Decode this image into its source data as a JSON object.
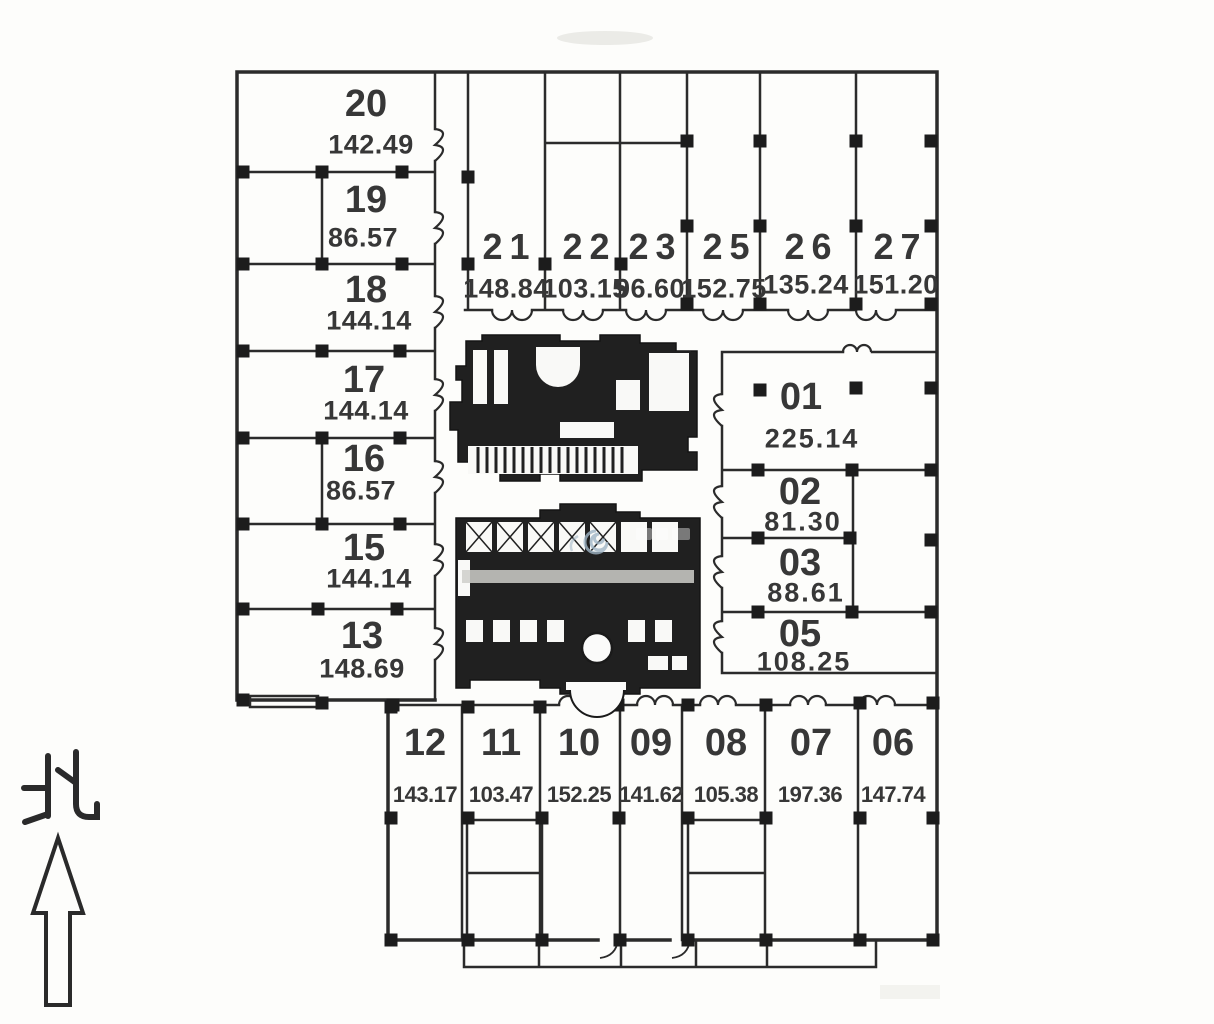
{
  "compass": {
    "label": "北",
    "icon": "north-arrow-icon"
  },
  "watermark": {
    "icon": "spiral-logo"
  },
  "units": {
    "left_wing": [
      {
        "no": "20",
        "area": "142.49"
      },
      {
        "no": "19",
        "area": "86.57"
      },
      {
        "no": "18",
        "area": "144.14"
      },
      {
        "no": "17",
        "area": "144.14"
      },
      {
        "no": "16",
        "area": "86.57"
      },
      {
        "no": "15",
        "area": "144.14"
      },
      {
        "no": "13",
        "area": "148.69"
      }
    ],
    "top_row": [
      {
        "no": "21",
        "area": "148.84"
      },
      {
        "no": "22",
        "area": "103.15"
      },
      {
        "no": "23",
        "area": "96.60"
      },
      {
        "no": "25",
        "area": "152.75"
      },
      {
        "no": "26",
        "area": "135.24"
      },
      {
        "no": "27",
        "area": "151.20"
      }
    ],
    "right_block": [
      {
        "no": "01",
        "area": "225.14"
      },
      {
        "no": "02",
        "area": "81.30"
      },
      {
        "no": "03",
        "area": "88.61"
      },
      {
        "no": "05",
        "area": "108.25"
      }
    ],
    "bottom_row": [
      {
        "no": "12",
        "area": "143.17"
      },
      {
        "no": "11",
        "area": "103.47"
      },
      {
        "no": "10",
        "area": "152.25"
      },
      {
        "no": "09",
        "area": "141.62"
      },
      {
        "no": "08",
        "area": "105.38"
      },
      {
        "no": "07",
        "area": "197.36"
      },
      {
        "no": "06",
        "area": "147.74"
      }
    ]
  },
  "colors": {
    "line": "#2b2b2b",
    "text": "#373737",
    "background": "#fdfdfb",
    "watermark": "#9fb4c4"
  }
}
